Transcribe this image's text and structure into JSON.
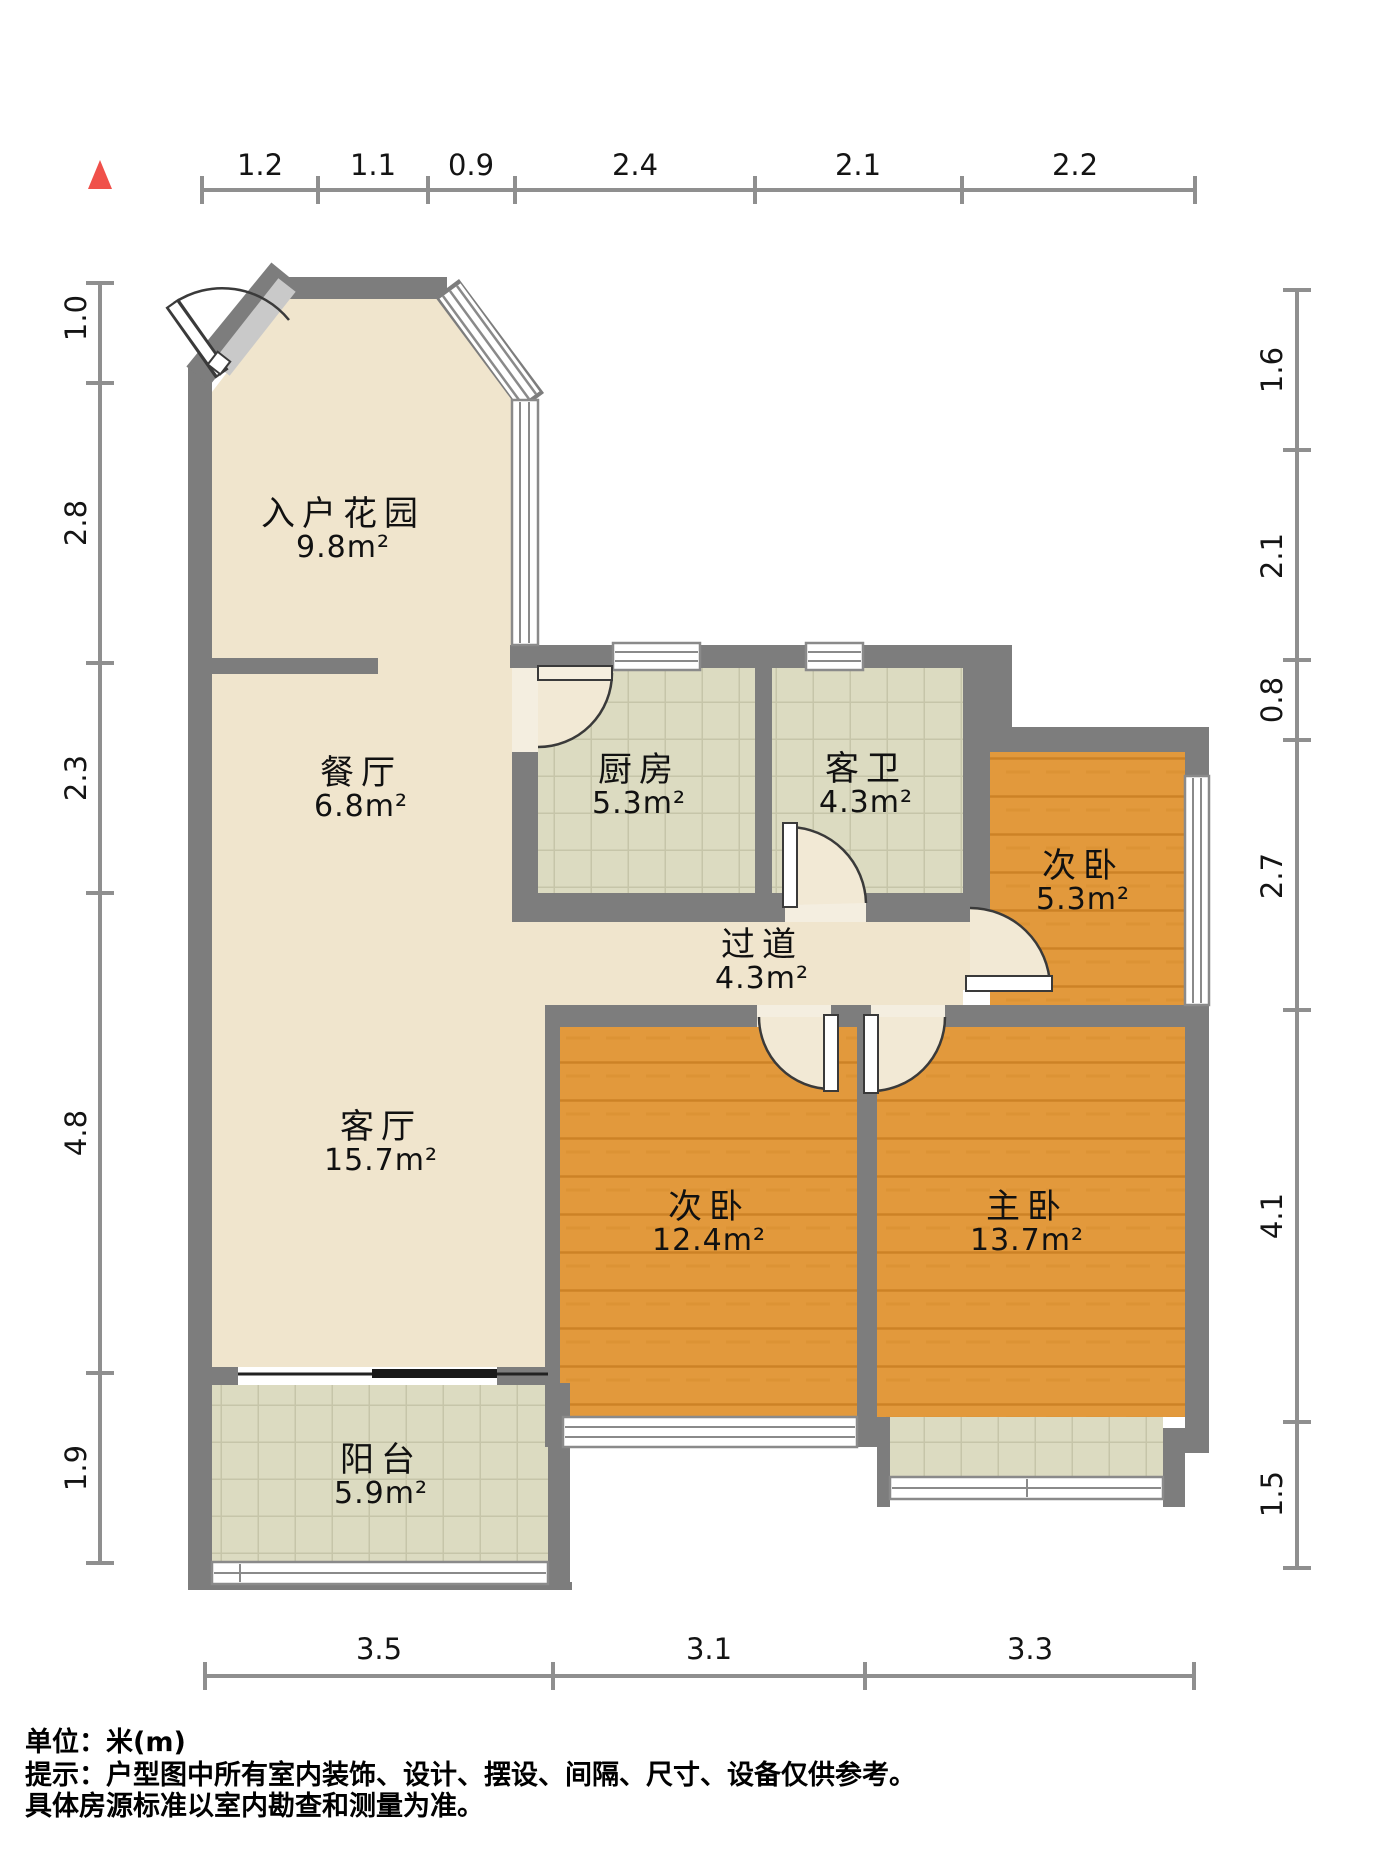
{
  "rooms": [
    {
      "id": "entrance-garden",
      "name": "入户花园",
      "area": "9.8m²"
    },
    {
      "id": "dining-room",
      "name": "餐厅",
      "area": "6.8m²"
    },
    {
      "id": "kitchen",
      "name": "厨房",
      "area": "5.3m²"
    },
    {
      "id": "guest-bathroom",
      "name": "客卫",
      "area": "4.3m²"
    },
    {
      "id": "second-bedroom-small",
      "name": "次卧",
      "area": "5.3m²"
    },
    {
      "id": "hallway",
      "name": "过道",
      "area": "4.3m²"
    },
    {
      "id": "living-room",
      "name": "客厅",
      "area": "15.7m²"
    },
    {
      "id": "second-bedroom",
      "name": "次卧",
      "area": "12.4m²"
    },
    {
      "id": "master-bedroom",
      "name": "主卧",
      "area": "13.7m²"
    },
    {
      "id": "balcony",
      "name": "阳台",
      "area": "5.9m²"
    }
  ],
  "rulers": {
    "top": [
      "1.2",
      "1.1",
      "0.9",
      "2.4",
      "2.1",
      "2.2"
    ],
    "bottom": [
      "3.5",
      "3.1",
      "3.3"
    ],
    "left": [
      "1.0",
      "2.8",
      "2.3",
      "4.8",
      "1.9"
    ],
    "right": [
      "1.6",
      "2.1",
      "0.8",
      "2.7",
      "4.1",
      "1.5"
    ]
  },
  "notes": {
    "unit": "单位：米(m)",
    "disclaimer1": "提示：户型图中所有室内装饰、设计、摆设、间隔、尺寸、设备仅供参考。",
    "disclaimer2": "具体房源标准以室内勘查和测量为准。"
  },
  "icons": {
    "north_indicator": "north-arrow"
  },
  "colors": {
    "wall": "#7d7d7d",
    "floor_marble": "#f0e5cd",
    "floor_tile": "#dcdbc1",
    "floor_wood": "#e2993c",
    "window_line": "#8a8a8a",
    "door_sector": "#f2e9d5",
    "compass_red": "#f0504a",
    "ruler": "#8f8f8f"
  }
}
